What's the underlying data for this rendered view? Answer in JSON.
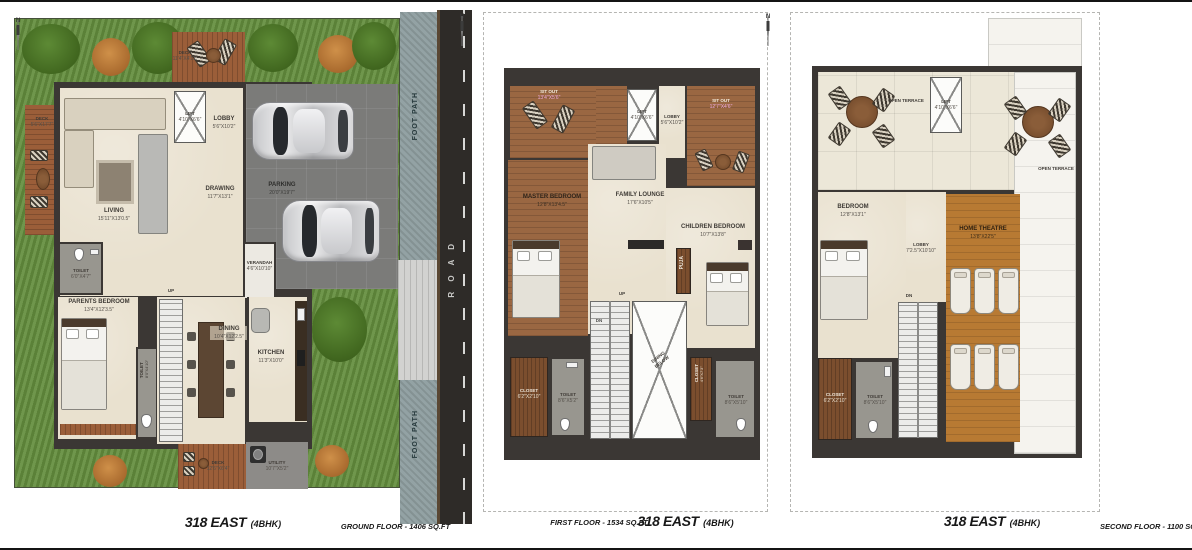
{
  "meta": {
    "north_label": "N"
  },
  "colors": {
    "lawn": "#648e3e",
    "deck_wood": "#9b5e39",
    "bedroom_wood": "#9a6742",
    "theatre_wood": "#b87a33",
    "floor_beige": "#e9e1cf",
    "wall": "#3b3734",
    "road": "#2e2b28",
    "footpath": "#93a2a4",
    "parking": "#7b7b79"
  },
  "plans": {
    "ground": {
      "title": "318 EAST",
      "bhk": "(4BHK)",
      "caption": "GROUND FLOOR - 1406 SQ.FT",
      "rooms": {
        "deck_top": {
          "label": "DECK",
          "dims": "11'4\"X4'11\""
        },
        "deck_left": {
          "label": "DECK",
          "dims": "5'6\"X17'7\""
        },
        "living": {
          "label": "LIVING",
          "dims": "15'11\"X13'0.5\""
        },
        "lift": {
          "label": "LIFT",
          "dims": "4'10\"X6'6\""
        },
        "lobby": {
          "label": "LOBBY",
          "dims": "5'6\"X10'2\""
        },
        "drawing": {
          "label": "DRAWING",
          "dims": "11'7\"X13'1\""
        },
        "parking": {
          "label": "PARKING",
          "dims": "20'0\"X19'7\""
        },
        "verandah": {
          "label": "VERANDAH",
          "dims": "4'6\"X10'10\""
        },
        "toilet1": {
          "label": "TOILET",
          "dims": "6'0\"X4'7\""
        },
        "parents": {
          "label": "PARENTS BEDROOM",
          "dims": "13'4\"X12'3.5\""
        },
        "toilet2": {
          "label": "TOILET",
          "dims": "8'0\"X4'10\""
        },
        "dining": {
          "label": "DINING",
          "dims": "10'4\"X12'2.5\""
        },
        "kitchen": {
          "label": "KITCHEN",
          "dims": "11'3\"X10'0\""
        },
        "deck_bottom": {
          "label": "DECK",
          "dims": "12'6\"X6'4\""
        },
        "utility": {
          "label": "UTILITY",
          "dims": "10'7\"X5'2\""
        },
        "up": "UP",
        "footpath_top": "FOOT PATH",
        "footpath_bottom": "FOOT PATH",
        "road": "R O A D"
      }
    },
    "first": {
      "title": "318 EAST",
      "bhk": "(4BHK)",
      "caption": "FIRST FLOOR - 1534 SQ.FT",
      "rooms": {
        "sitout_left": {
          "label": "SIT OUT",
          "dims": "13'4\"X5'6\""
        },
        "lift": {
          "label": "LIFT",
          "dims": "4'10\"X6'6\""
        },
        "lobby": {
          "label": "LOBBY",
          "dims": "5'6\"X10'2\""
        },
        "sitout_right": {
          "label": "SIT OUT",
          "dims": "12'7\"X4'6\""
        },
        "master": {
          "label": "MASTER BEDROOM",
          "dims": "12'8\"X13'4.5\""
        },
        "family": {
          "label": "FAMILY LOUNGE",
          "dims": "17'6\"X10'5\""
        },
        "children": {
          "label": "CHILDREN BEDROOM",
          "dims": "10'7\"X13'8\""
        },
        "puja": "PUJA",
        "up": "UP",
        "dn": "DN",
        "dining_below": "DINING BELOW",
        "closet_left": {
          "label": "CLOSET",
          "dims": "6'2\"X2'10\""
        },
        "toilet_left": {
          "label": "TOILET",
          "dims": "8'6\"X5'2\""
        },
        "closet_right": {
          "label": "CLOSET",
          "dims": "4'6\"X7'3\""
        },
        "toilet_right": {
          "label": "TOILET",
          "dims": "8'6\"X5'10\""
        }
      }
    },
    "second": {
      "title": "318 EAST",
      "bhk": "(4BHK)",
      "caption": "SECOND FLOOR - 1100 SQ.FT",
      "rooms": {
        "terrace_top": "OPEN TERRACE",
        "terrace_right": "OPEN TERRACE",
        "lift": {
          "label": "LIFT",
          "dims": "4'10\"X6'6\""
        },
        "bedroom": {
          "label": "BEDROOM",
          "dims": "12'8\"X13'1\""
        },
        "lobby": {
          "label": "LOBBY",
          "dims": "7'2.5\"X10'10\""
        },
        "theatre": {
          "label": "HOME THEATRE",
          "dims": "13'8\"X22'5\""
        },
        "dn": "DN",
        "closet": {
          "label": "CLOSET",
          "dims": "6'2\"X2'10\""
        },
        "toilet": {
          "label": "TOILET",
          "dims": "8'6\"X5'10\""
        }
      }
    }
  }
}
